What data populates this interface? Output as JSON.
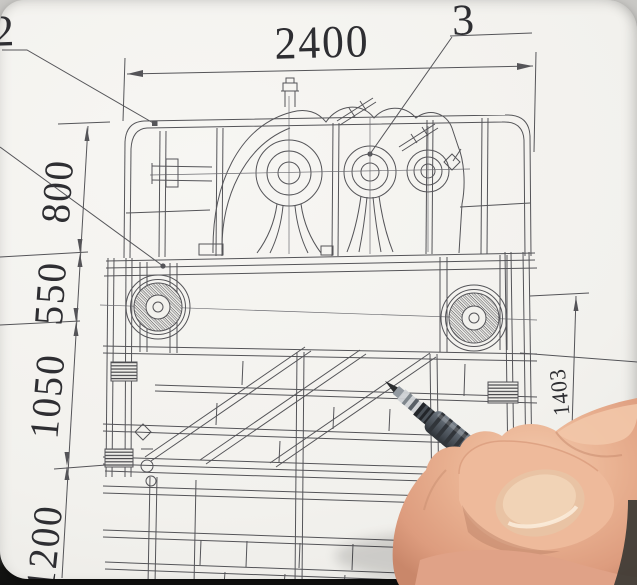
{
  "dims": {
    "top": "2400",
    "left1": "800",
    "left2": "550",
    "left3": "1050",
    "left4": "1200",
    "right": "1403"
  },
  "callouts": {
    "c2": "2",
    "c3": "3"
  },
  "colors": {
    "paper": "#f2f1ed",
    "ink": "#3d3d42",
    "pen_barrel": "#4d545b",
    "pen_grip": "#23262a",
    "skin": "#e9b395",
    "nail": "#eecaa9",
    "background": "#b3b2af",
    "edge_shadow": "#161614"
  }
}
